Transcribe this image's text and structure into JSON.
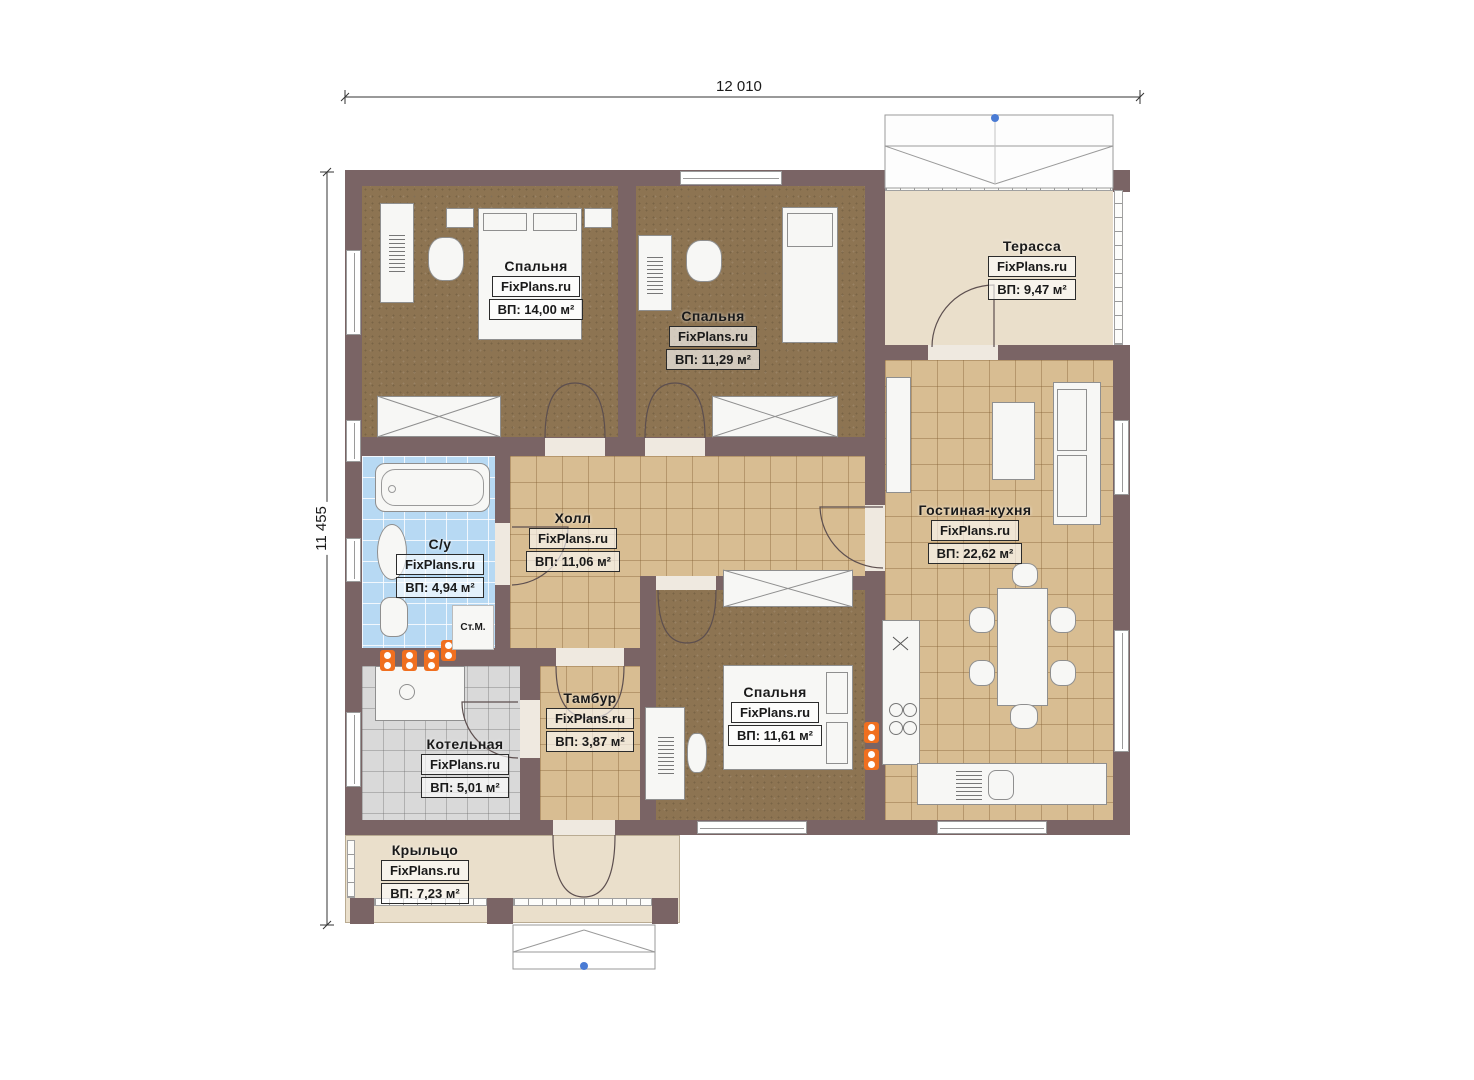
{
  "dimensions": {
    "width": "12 010",
    "height": "11 455"
  },
  "watermark": "FixPlans.ru",
  "rooms": [
    {
      "id": "bedroom-1",
      "name": "Спальня",
      "area": "ВП: 14,00 м²"
    },
    {
      "id": "bedroom-2",
      "name": "Спальня",
      "area": "ВП: 11,29 м²"
    },
    {
      "id": "terrace",
      "name": "Терасса",
      "area": "ВП: 9,47 м²"
    },
    {
      "id": "hall",
      "name": "Холл",
      "area": "ВП: 11,06 м²"
    },
    {
      "id": "bathroom",
      "name": "С/у",
      "area": "ВП: 4,94 м²"
    },
    {
      "id": "living-kitchen",
      "name": "Гостиная-кухня",
      "area": "ВП: 22,62 м²"
    },
    {
      "id": "vestibule",
      "name": "Тамбур",
      "area": "ВП: 3,87 м²"
    },
    {
      "id": "boiler-room",
      "name": "Котельная",
      "area": "ВП: 5,01 м²"
    },
    {
      "id": "bedroom-3",
      "name": "Спальня",
      "area": "ВП: 11,61 м²"
    },
    {
      "id": "porch",
      "name": "Крыльцо",
      "area": "ВП: 7,23 м²"
    }
  ],
  "annotations": {
    "washing_machine": "Ст.М."
  },
  "colors": {
    "wall": "#7a6465",
    "carpet": "#8d7452",
    "tile": "#d8bd92",
    "bath_tile": "#b7d9f3",
    "boiler_tile": "#d9d9d9",
    "terrace": "#eadfcb",
    "socket": "#f06f1f",
    "marker_blue": "#4a7bd4"
  }
}
